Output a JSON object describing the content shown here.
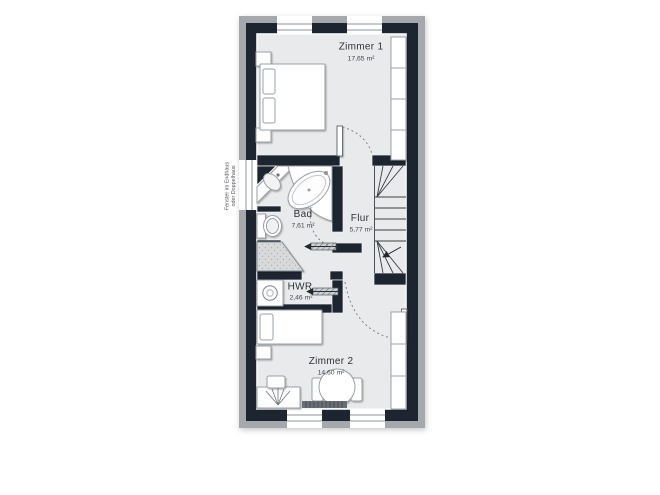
{
  "plan": {
    "kind": "floor-plan",
    "note": {
      "line1": "Fenster im Endhaus",
      "line2": "oder Doppelhaus"
    },
    "rooms": [
      {
        "name": "Zimmer 1",
        "area": "17,65 m²"
      },
      {
        "name": "Bad",
        "area": "7,61 m²"
      },
      {
        "name": "Flur",
        "area": "5,77 m²"
      },
      {
        "name": "HWR",
        "area": "2,46 m²"
      },
      {
        "name": "Zimmer 2",
        "area": "14,60 m²"
      }
    ],
    "fixtures": [
      "double-bed",
      "nightstand",
      "wardrobe",
      "corner-washbasin",
      "corner-bathtub",
      "toilet",
      "shower",
      "washing-machine",
      "winder-staircase",
      "sliding-door",
      "swing-door",
      "single-bed",
      "desk",
      "desk-lamp",
      "desk-chair",
      "round-table",
      "chair",
      "radiator",
      "window"
    ],
    "colors": {
      "wall": "#1d2531",
      "outer_band": "#a5a8ac",
      "floor": "#e9eaeb",
      "background": "#ffffff",
      "fixture_stroke": "#9aa0a6"
    }
  }
}
